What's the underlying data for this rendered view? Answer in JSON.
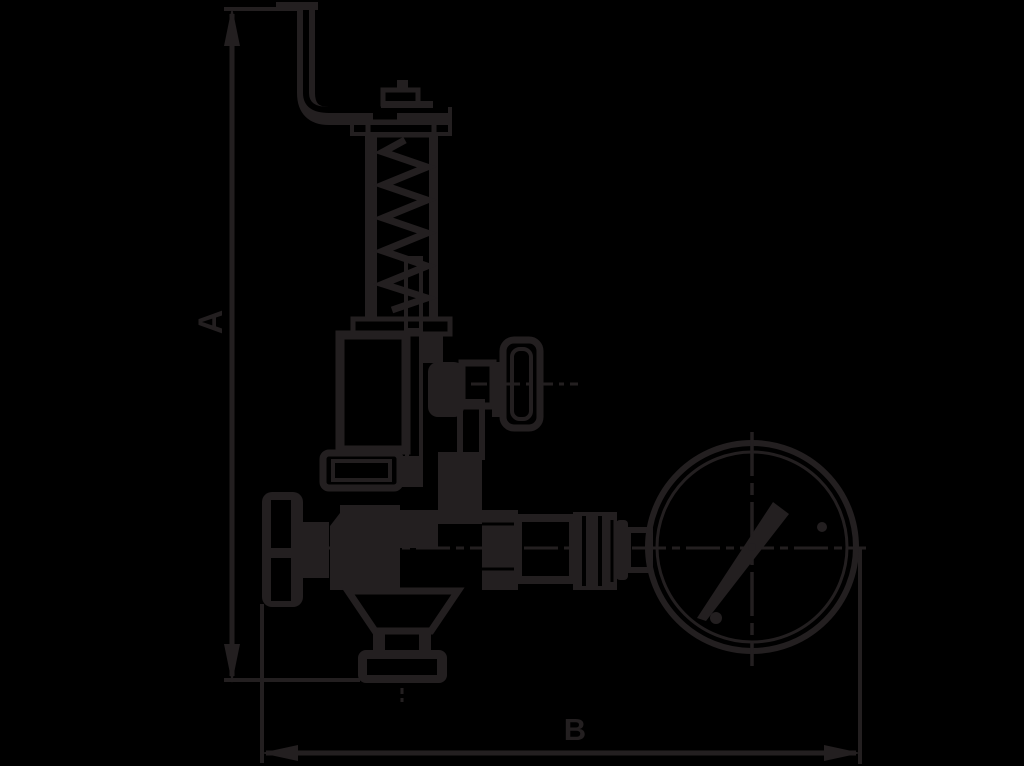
{
  "canvas": {
    "width": 1024,
    "height": 766,
    "background": "#000000",
    "ink": "#231f20"
  },
  "drawing": {
    "kind": "valve-assembly-dimension-drawing",
    "labels": {
      "dim_vertical": "A",
      "dim_horizontal": "B"
    }
  }
}
